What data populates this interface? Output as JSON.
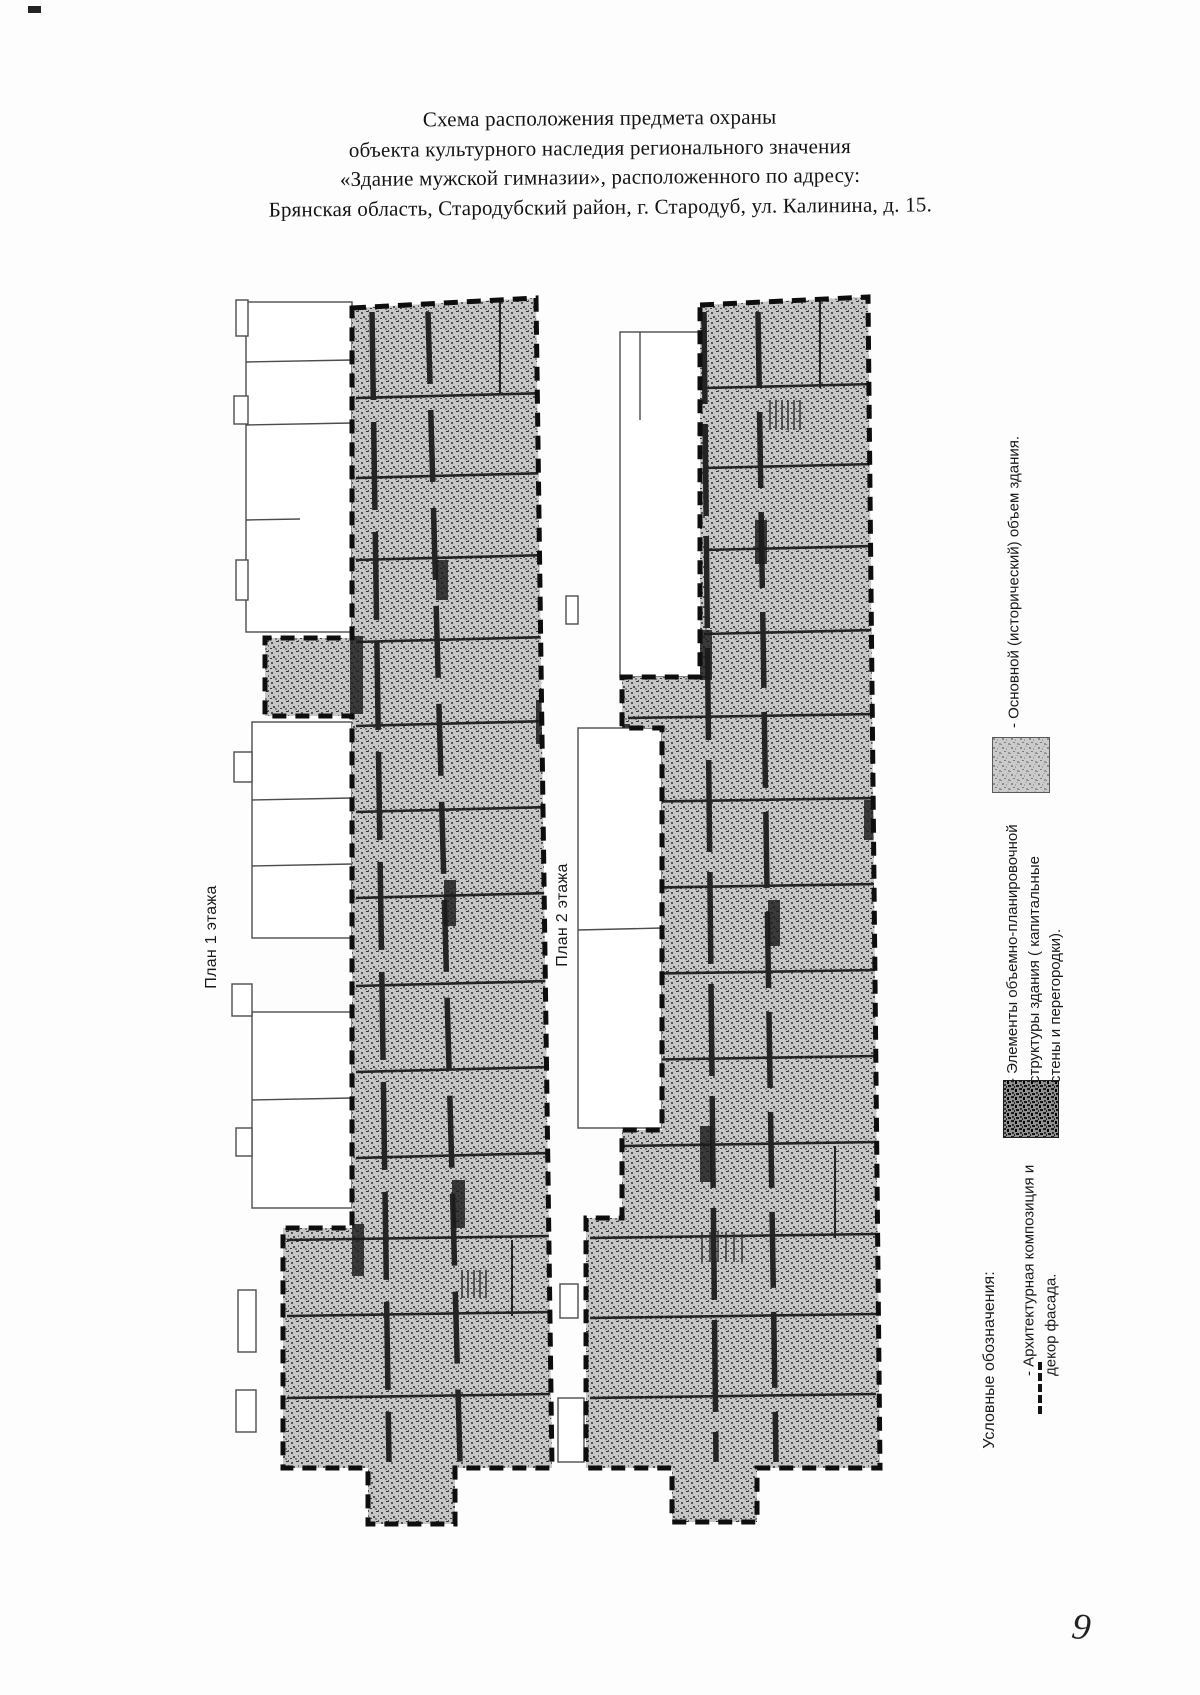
{
  "title": {
    "lines": [
      "Схема расположения предмета охраны",
      "объекта культурного наследия регионального значения",
      "«Здание мужской гимназии», расположенного по адресу:",
      "Брянская область, Стародубский район, г. Стародуб, ул. Калинина, д. 15."
    ]
  },
  "plans": [
    {
      "label": "План 1 этажа"
    },
    {
      "label": "План 2 этажа"
    }
  ],
  "legend": {
    "header": "Условные обозначения:",
    "items": [
      {
        "symbol": "dashed-line",
        "label": "- Архитектурная композиция и декор фасада."
      },
      {
        "symbol": "dark-hatch-square",
        "label": "- Элементы объемно-планировочной структуры здания ( капитальные стены и перегородки)."
      },
      {
        "symbol": "gray-stipple-square",
        "label": "- Основной (исторический) объем здания."
      }
    ]
  },
  "page_number": "9",
  "colors": {
    "paper": "#fdfdfd",
    "ink": "#161616",
    "boundary_dash": "#0e0e0e",
    "stipple_fill": "#c6c6c6",
    "stipple_speck": "#4a4a4a"
  }
}
